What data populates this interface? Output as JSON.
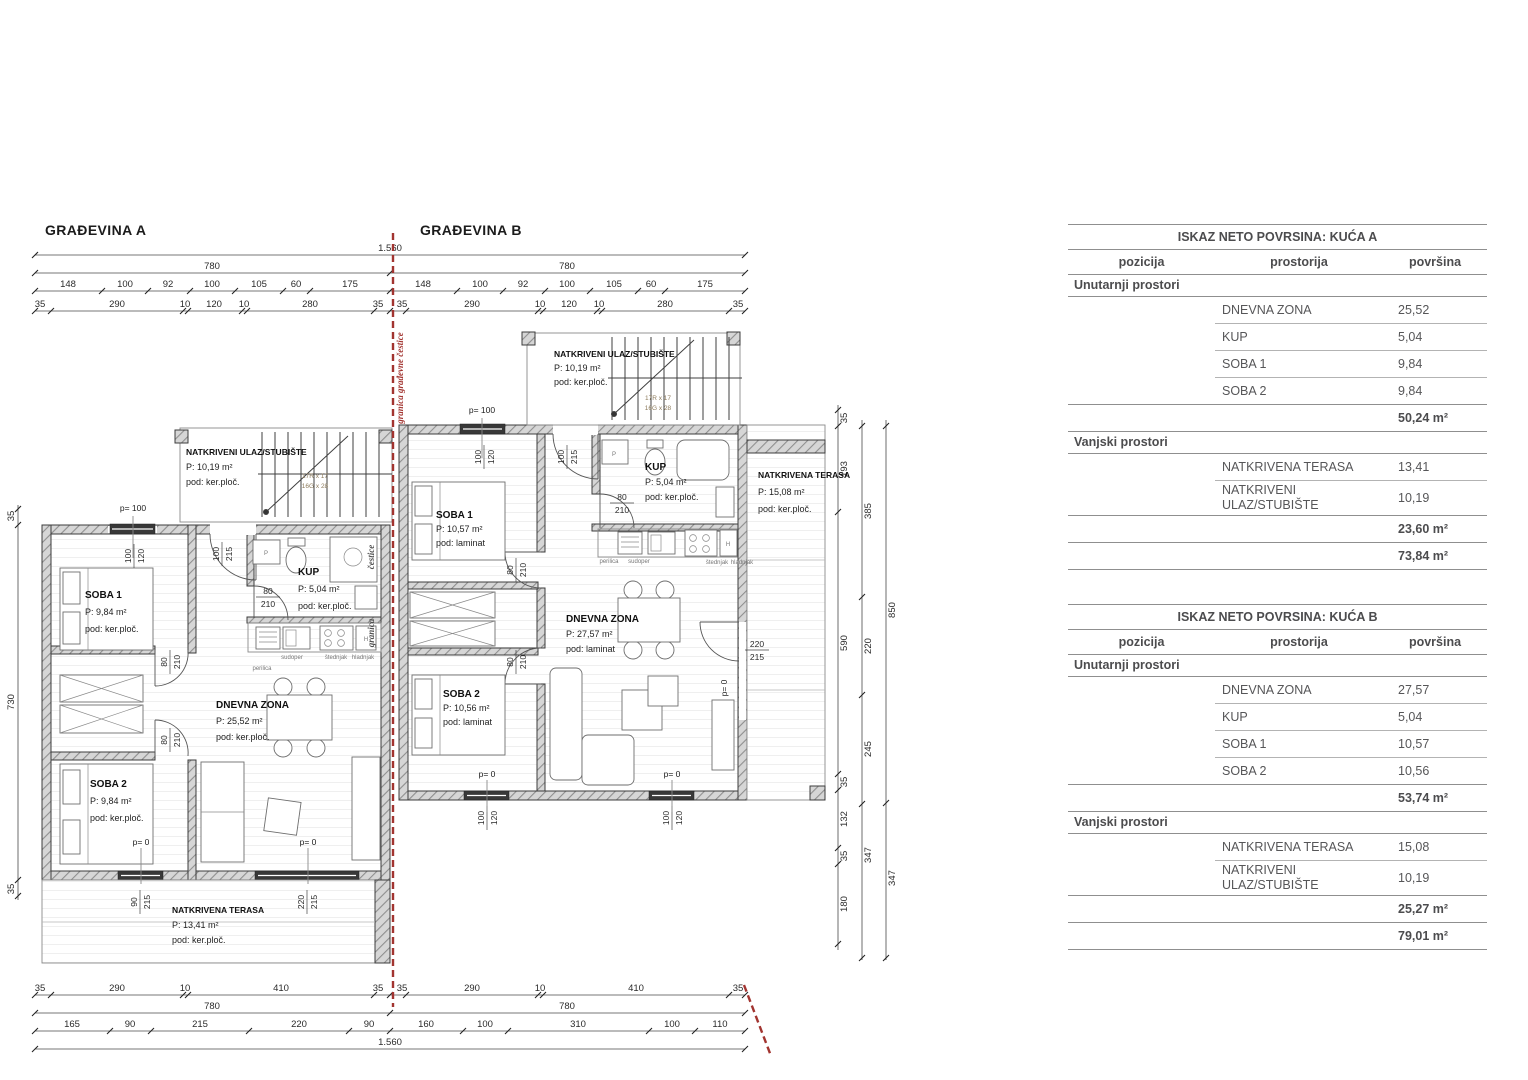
{
  "plan": {
    "title_a": "GRAĐEVINA A",
    "title_b": "GRAĐEVINA B",
    "boundary_label_full": "granica građevne čestice",
    "boundary_word_1": "granica",
    "boundary_word_2": "čestice",
    "stair_note_1": "17R x 17",
    "stair_note_2": "16G x 28",
    "levels": {
      "p100": "p= 100",
      "p0": "p= 0"
    },
    "kitchen": {
      "perilica": "perilica",
      "sudoper": "sudoper",
      "stednjak": "štednjak",
      "hladnjak": "hladnjak",
      "p": "P",
      "h": "H"
    },
    "openings": {
      "win_100_120": [
        "100",
        "120"
      ],
      "door_100_215": [
        "100",
        "215"
      ],
      "door_80_210": [
        "80",
        "210"
      ],
      "door_90_215": [
        "90",
        "215"
      ],
      "door_220_215": [
        "220",
        "215"
      ]
    },
    "dims": {
      "total": "1.560",
      "half_a": "780",
      "half_b": "780",
      "top_seg_a": [
        "148",
        "100",
        "92",
        "100",
        "105",
        "60",
        "175"
      ],
      "top_seg_b": [
        "148",
        "100",
        "92",
        "100",
        "105",
        "60",
        "175"
      ],
      "top_sub_a": [
        "35",
        "290",
        "10",
        "120",
        "10",
        "280",
        "35"
      ],
      "top_sub_b": [
        "35",
        "290",
        "10",
        "120",
        "10",
        "280",
        "35"
      ],
      "bot_seg_a": [
        "35",
        "290",
        "10",
        "410",
        "35"
      ],
      "bot_seg_b": [
        "35",
        "290",
        "10",
        "410",
        "35"
      ],
      "bot_half_a": "780",
      "bot_half_b": "780",
      "bot_sub_a": [
        "165",
        "90",
        "215",
        "220",
        "90"
      ],
      "bot_sub_b": [
        "160",
        "100",
        "310",
        "100",
        "110"
      ],
      "bot_total": "1.560",
      "left": [
        "35",
        "730",
        "35"
      ],
      "right_inner": [
        "35",
        "193",
        "590",
        "35",
        "132",
        "35",
        "180"
      ],
      "right_mid": [
        "385",
        "220",
        "245",
        "347"
      ],
      "right_outer": [
        "850",
        "347"
      ]
    },
    "house_a": {
      "soba1": {
        "name": "SOBA 1",
        "area": "P: 9,84 m²",
        "floor": "pod: ker.ploč."
      },
      "soba2": {
        "name": "SOBA 2",
        "area": "P: 9,84 m²",
        "floor": "pod: ker.ploč."
      },
      "kup": {
        "name": "KUP",
        "area": "P: 5,04 m²",
        "floor": "pod: ker.ploč."
      },
      "dnevna": {
        "name": "DNEVNA ZONA",
        "area": "P: 25,52 m²",
        "floor": "pod: ker.ploč."
      },
      "ulaz": {
        "name": "NATKRIVENI ULAZ/STUBIŠTE",
        "area": "P: 10,19 m²",
        "floor": "pod: ker.ploč."
      },
      "terasa": {
        "name": "NATKRIVENA TERASA",
        "area": "P: 13,41 m²",
        "floor": "pod: ker.ploč."
      }
    },
    "house_b": {
      "soba1": {
        "name": "SOBA 1",
        "area": "P: 10,57 m²",
        "floor": "pod: laminat"
      },
      "soba2": {
        "name": "SOBA 2",
        "area": "P: 10,56 m²",
        "floor": "pod: laminat"
      },
      "kup": {
        "name": "KUP",
        "area": "P: 5,04 m²",
        "floor": "pod: ker.ploč."
      },
      "dnevna": {
        "name": "DNEVNA ZONA",
        "area": "P: 27,57 m²",
        "floor": "pod: laminat"
      },
      "ulaz": {
        "name": "NATKRIVENI ULAZ/STUBIŠTE",
        "area": "P: 10,19 m²",
        "floor": "pod: ker.ploč."
      },
      "terasa": {
        "name": "NATKRIVENA TERASA",
        "area": "P: 15,08 m²",
        "floor": "pod: ker.ploč."
      }
    }
  },
  "tables": [
    {
      "title": "ISKAZ NETO POVRSINA: KUĆA A",
      "headers": [
        "pozicija",
        "prostorija",
        "površina"
      ],
      "sections": [
        {
          "label": "Unutarnji prostori",
          "rows": [
            {
              "prostorija": "DNEVNA ZONA",
              "povrsina": "25,52"
            },
            {
              "prostorija": "KUP",
              "povrsina": "5,04"
            },
            {
              "prostorija": "SOBA 1",
              "povrsina": "9,84"
            },
            {
              "prostorija": "SOBA 2",
              "povrsina": "9,84"
            }
          ],
          "subtotal": "50,24 m²"
        },
        {
          "label": "Vanjski prostori",
          "rows": [
            {
              "prostorija": "NATKRIVENA TERASA",
              "povrsina": "13,41"
            },
            {
              "prostorija": "NATKRIVENI ULAZ/STUBIŠTE",
              "povrsina": "10,19"
            }
          ],
          "subtotal": "23,60 m²"
        }
      ],
      "total": "73,84 m²"
    },
    {
      "title": "ISKAZ NETO POVRSINA: KUĆA B",
      "headers": [
        "pozicija",
        "prostorija",
        "površina"
      ],
      "sections": [
        {
          "label": "Unutarnji prostori",
          "rows": [
            {
              "prostorija": "DNEVNA ZONA",
              "povrsina": "27,57"
            },
            {
              "prostorija": "KUP",
              "povrsina": "5,04"
            },
            {
              "prostorija": "SOBA 1",
              "povrsina": "10,57"
            },
            {
              "prostorija": "SOBA 2",
              "povrsina": "10,56"
            }
          ],
          "subtotal": "53,74 m²"
        },
        {
          "label": "Vanjski prostori",
          "rows": [
            {
              "prostorija": "NATKRIVENA TERASA",
              "povrsina": "15,08"
            },
            {
              "prostorija": "NATKRIVENI ULAZ/STUBIŠTE",
              "povrsina": "10,19"
            }
          ],
          "subtotal": "25,27 m²"
        }
      ],
      "total": "79,01 m²"
    }
  ]
}
